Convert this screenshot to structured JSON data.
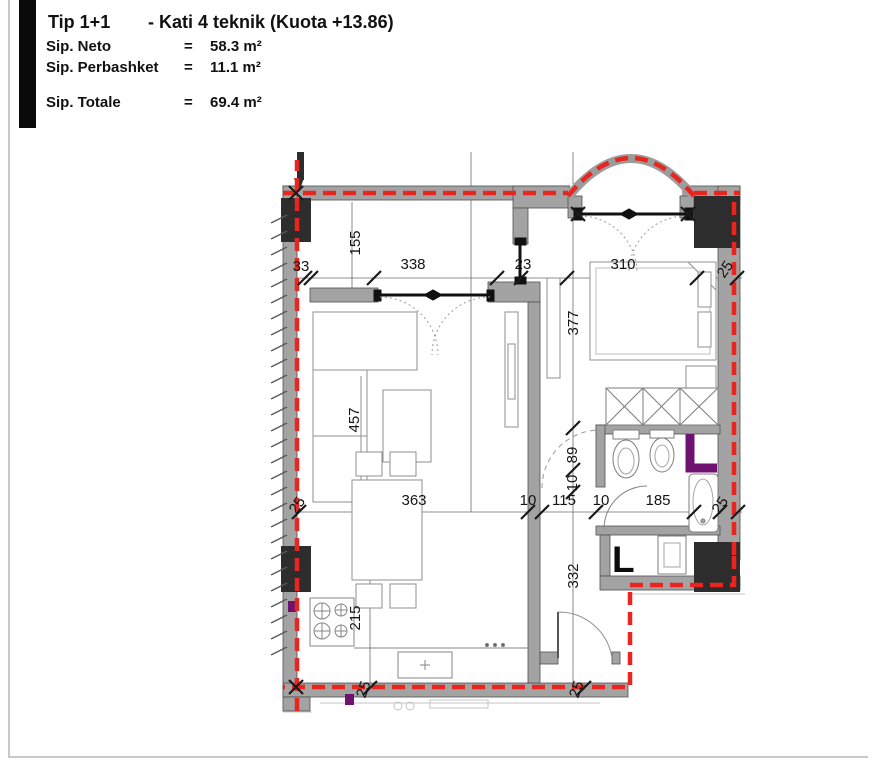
{
  "header": {
    "title_type": "Tip 1+1",
    "title_floor": "- Kati 4 teknik (Kuota +13.86)",
    "rows": [
      {
        "label": "Sip. Neto",
        "eq": "=",
        "value": "58.3 m²"
      },
      {
        "label": "Sip. Perbashket",
        "eq": "=",
        "value": "11.1 m²"
      },
      {
        "label": "Sip. Totale",
        "eq": "=",
        "value": "69.4 m²"
      }
    ]
  },
  "plan": {
    "room_label": "L",
    "colors": {
      "boundary_red": "#e8251f",
      "accent_purple": "#6e1170",
      "wall_gray": "#a3a3a3",
      "column_dark": "#2d2d2d"
    },
    "dimensions": [
      {
        "value": "155",
        "x": 360,
        "y": 243,
        "rot": -90
      },
      {
        "value": "33",
        "x": 301,
        "y": 271,
        "rot": 0
      },
      {
        "value": "338",
        "x": 413,
        "y": 269,
        "rot": 0
      },
      {
        "value": "23",
        "x": 523,
        "y": 269,
        "rot": 0
      },
      {
        "value": "310",
        "x": 623,
        "y": 269,
        "rot": 0
      },
      {
        "value": "25",
        "x": 729,
        "y": 272,
        "rot": -55
      },
      {
        "value": "377",
        "x": 578,
        "y": 323,
        "rot": -90
      },
      {
        "value": "457",
        "x": 359,
        "y": 420,
        "rot": -90
      },
      {
        "value": "89",
        "x": 577,
        "y": 455,
        "rot": -90
      },
      {
        "value": "10",
        "x": 577,
        "y": 483,
        "rot": -90
      },
      {
        "value": "25",
        "x": 301,
        "y": 508,
        "rot": -55
      },
      {
        "value": "363",
        "x": 414,
        "y": 505,
        "rot": 0
      },
      {
        "value": "10",
        "x": 528,
        "y": 505,
        "rot": 0
      },
      {
        "value": "115",
        "x": 564,
        "y": 505,
        "rot": 0
      },
      {
        "value": "10",
        "x": 601,
        "y": 505,
        "rot": 0
      },
      {
        "value": "185",
        "x": 658,
        "y": 505,
        "rot": 0
      },
      {
        "value": "25",
        "x": 724,
        "y": 508,
        "rot": -55
      },
      {
        "value": "215",
        "x": 360,
        "y": 618,
        "rot": -90
      },
      {
        "value": "332",
        "x": 578,
        "y": 576,
        "rot": -90
      },
      {
        "value": "25",
        "x": 368,
        "y": 691,
        "rot": -70
      },
      {
        "value": "25",
        "x": 581,
        "y": 691,
        "rot": -70
      }
    ]
  }
}
